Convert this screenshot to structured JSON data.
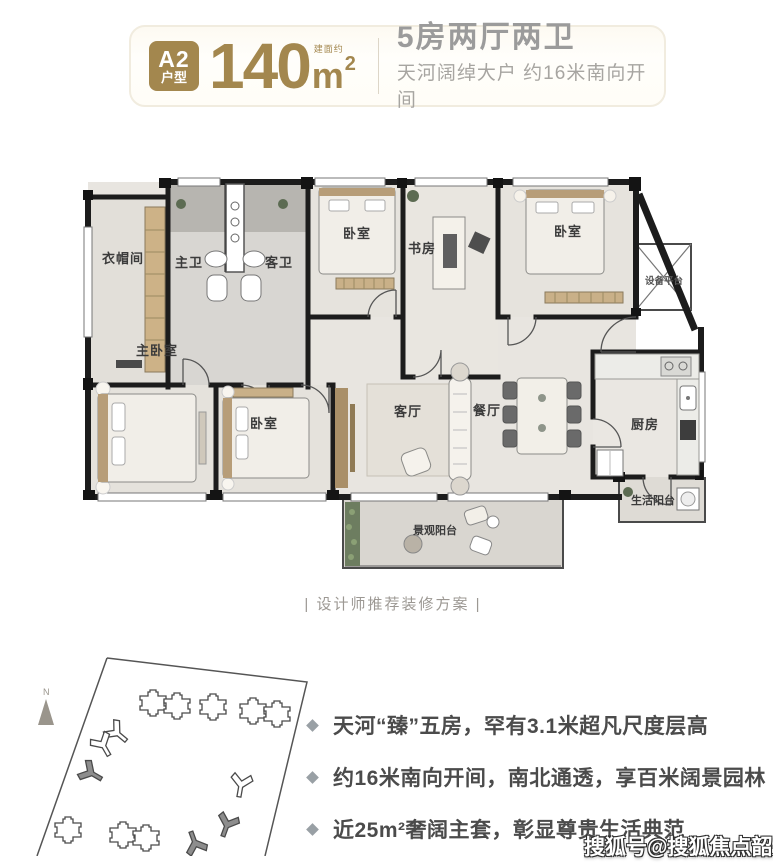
{
  "header": {
    "badge": {
      "line1": "A2",
      "line2": "户型"
    },
    "area": {
      "value": "140",
      "note": "建面约",
      "unit": "m",
      "sup": "2"
    },
    "title": "5房两厅两卫",
    "subtitle": "天河阔绰大户 约16米南向开间"
  },
  "plan": {
    "caption": "| 设计师推荐装修方案 |",
    "rooms": {
      "closet": "衣帽间",
      "master_bath": "主卫",
      "guest_bath": "客卫",
      "bedroom_top": "卧室",
      "study": "书房",
      "bedroom_top_right": "卧室",
      "equipment": "设备平台",
      "master_bedroom": "主卧室",
      "bedroom_bottom": "卧室",
      "living": "客厅",
      "dining": "餐厅",
      "kitchen": "厨房",
      "service_balcony": "生活阳台",
      "view_balcony": "景观阳台"
    }
  },
  "site_plan": {
    "north_label": "N"
  },
  "features": {
    "items": [
      "天河“臻”五房，罕有3.1米超凡尺度层高",
      "约16米南向开间，南北通透，享百米阔景园林",
      "近25m²奢阔主套，彰显尊贵生活典范"
    ]
  },
  "watermark": "搜狐号@搜狐焦点韶关站",
  "colors": {
    "accent_gold": "#a3874e",
    "title_gray": "#9b9b9b",
    "feature_text": "#4b4b4b",
    "wall_black": "#1c1c1c"
  }
}
